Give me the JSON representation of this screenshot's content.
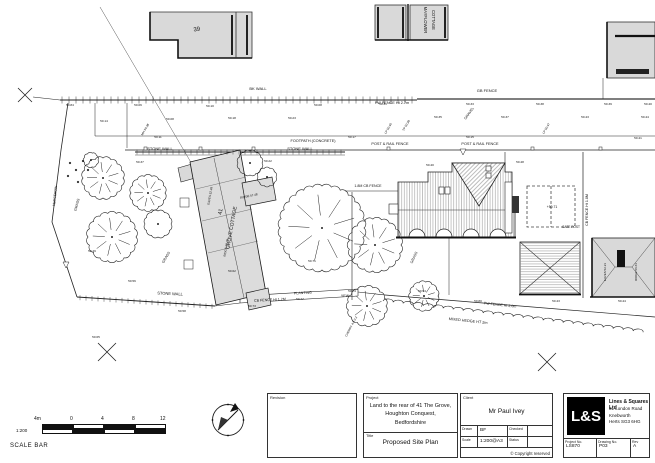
{
  "title_block": {
    "revision_label": "Revision",
    "project_label": "Project",
    "project_lines": [
      "Land to the rear of 41 The Grove,",
      "Houghton Conquest,",
      "Bedfordshire"
    ],
    "title_label": "Title",
    "title": "Proposed Site Plan",
    "client_label": "Client",
    "client": "Mr Paul Ivey",
    "drawn_label": "Drawn",
    "drawn": "BF",
    "checked_label": "Checked",
    "checked": "",
    "scale_label": "Scale",
    "scale": "1:200@A3",
    "status_label": "Status",
    "status": "",
    "copyright": "© Copyright reserved",
    "logo_text": "L&S",
    "company_name": "Lines & Squares Ltd",
    "company_address": [
      "81 London Road",
      "Knebworth",
      "Herts SG3 6HG"
    ],
    "project_no_label": "Project No.",
    "project_no": "LS870",
    "drawing_no_label": "Drawing No.",
    "drawing_no": "P03",
    "rev_label": "Rev",
    "rev": "A"
  },
  "scale_bar": {
    "ratio": "1:200",
    "caption": "SCALE BAR",
    "tick_labels": [
      "4m",
      "0",
      "4",
      "8",
      "12"
    ]
  },
  "plan": {
    "labels": [
      {
        "t": "BK WALL",
        "x": 258,
        "y": 90,
        "s": 4
      },
      {
        "t": "GB FENCE",
        "x": 487,
        "y": 92,
        "s": 4
      },
      {
        "t": "PW FENCE Ht 2.7m",
        "x": 392,
        "y": 104,
        "s": 3.8
      },
      {
        "t": "FOOTPATH (CONCRETE)",
        "x": 313,
        "y": 142,
        "s": 3.8
      },
      {
        "t": "POST & RAIL FENCE",
        "x": 390,
        "y": 145,
        "s": 3.8
      },
      {
        "t": "POST & RAIL FENCE",
        "x": 480,
        "y": 145,
        "s": 3.8
      },
      {
        "t": "39",
        "x": 197,
        "y": 31,
        "s": 6,
        "r": -8
      },
      {
        "t": "MAYFLOWER",
        "x": 424,
        "y": 20,
        "s": 4.2,
        "r": 90
      },
      {
        "t": "COTTAGE",
        "x": 432,
        "y": 20,
        "s": 4.2,
        "r": 90
      },
      {
        "t": "STONE WALL",
        "x": 160,
        "y": 150,
        "s": 4
      },
      {
        "t": "STONE WALL",
        "x": 300,
        "y": 150,
        "s": 4
      },
      {
        "t": "STONE WALL",
        "x": 170,
        "y": 295,
        "s": 4,
        "r": 3
      },
      {
        "t": "1.8M CB FENCE",
        "x": 368,
        "y": 187,
        "s": 3.6
      },
      {
        "t": "CB FENCE Ht 1.2M",
        "x": 270,
        "y": 301,
        "s": 3.6,
        "r": -3
      },
      {
        "t": "PLANTING",
        "x": 303,
        "y": 294,
        "s": 3.6,
        "r": -3
      },
      {
        "t": "YEW",
        "x": 345,
        "y": 297,
        "s": 3.6
      },
      {
        "t": "MIXED HEDGE HT 2m",
        "x": 468,
        "y": 322,
        "s": 3.8,
        "r": 6
      },
      {
        "t": "PW FENCE Ht 2.0m",
        "x": 500,
        "y": 306,
        "s": 3.6,
        "r": 6
      },
      {
        "t": "CB FENCE Ht 1.8M",
        "x": 588,
        "y": 210,
        "s": 3.6,
        "r": -90
      },
      {
        "t": "GATE POST",
        "x": 571,
        "y": 228,
        "s": 3.2
      },
      {
        "t": "41",
        "x": 222,
        "y": 212,
        "s": 5.5,
        "r": -80
      },
      {
        "t": "GROVE COTTAGE",
        "x": 233,
        "y": 228,
        "s": 5,
        "r": -80
      },
      {
        "t": "GRASS",
        "x": 78,
        "y": 205,
        "s": 3.6,
        "r": -75
      },
      {
        "t": "GRASS",
        "x": 167,
        "y": 258,
        "s": 3.6,
        "r": -60
      },
      {
        "t": "GRASS",
        "x": 415,
        "y": 258,
        "s": 3.6,
        "r": -65
      },
      {
        "t": "GRAVEL",
        "x": 470,
        "y": 114,
        "s": 3.6,
        "r": -55
      },
      {
        "t": "HEDGEROW",
        "x": 56,
        "y": 196,
        "s": 3.4,
        "r": -84
      },
      {
        "t": "CHERRY 4.0 0.2",
        "x": 352,
        "y": 327,
        "s": 3,
        "r": -62
      },
      {
        "t": "EAVES 52.48",
        "x": 211,
        "y": 196,
        "s": 3,
        "r": -80
      },
      {
        "t": "RIDGE 56.76",
        "x": 227,
        "y": 248,
        "s": 3,
        "r": -80
      },
      {
        "t": "RIDGE 57.48",
        "x": 249,
        "y": 197,
        "s": 3,
        "r": -12
      },
      {
        "t": "EAVES 52.21",
        "x": 606,
        "y": 272,
        "s": 3,
        "r": -90
      },
      {
        "t": "RIDGE 56.61",
        "x": 637,
        "y": 272,
        "s": 3,
        "r": -90
      },
      {
        "t": "+50.71",
        "x": 552,
        "y": 208,
        "s": 3.4
      },
      {
        "t": "MH 50.38",
        "x": 146,
        "y": 130,
        "s": 3,
        "r": -60
      },
      {
        "t": "LP 50.40",
        "x": 389,
        "y": 129,
        "s": 3,
        "r": -60
      },
      {
        "t": "TP 50.38",
        "x": 407,
        "y": 126,
        "s": 3,
        "r": -60
      },
      {
        "t": "LP 50.47",
        "x": 547,
        "y": 129,
        "s": 3,
        "r": -60
      },
      {
        "t": "50.84",
        "x": 70,
        "y": 106
      },
      {
        "t": "50.06",
        "x": 138,
        "y": 106
      },
      {
        "t": "50.10",
        "x": 210,
        "y": 107
      },
      {
        "t": "50.08",
        "x": 318,
        "y": 106
      },
      {
        "t": "50.31",
        "x": 383,
        "y": 105
      },
      {
        "t": "50.33",
        "x": 470,
        "y": 105
      },
      {
        "t": "50.38",
        "x": 540,
        "y": 105
      },
      {
        "t": "50.39",
        "x": 608,
        "y": 105
      },
      {
        "t": "50.40",
        "x": 648,
        "y": 105
      },
      {
        "t": "50.14",
        "x": 104,
        "y": 122
      },
      {
        "t": "50.08",
        "x": 170,
        "y": 120
      },
      {
        "t": "50.18",
        "x": 232,
        "y": 119
      },
      {
        "t": "50.23",
        "x": 292,
        "y": 119
      },
      {
        "t": "50.35",
        "x": 438,
        "y": 118
      },
      {
        "t": "50.37",
        "x": 505,
        "y": 118
      },
      {
        "t": "50.43",
        "x": 585,
        "y": 118
      },
      {
        "t": "50.44",
        "x": 645,
        "y": 118
      },
      {
        "t": "50.11",
        "x": 158,
        "y": 138
      },
      {
        "t": "50.17",
        "x": 352,
        "y": 138
      },
      {
        "t": "50.15",
        "x": 470,
        "y": 138
      },
      {
        "t": "50.41",
        "x": 638,
        "y": 139
      },
      {
        "t": "50.37",
        "x": 140,
        "y": 163
      },
      {
        "t": "50.22",
        "x": 268,
        "y": 162
      },
      {
        "t": "50.40",
        "x": 430,
        "y": 166
      },
      {
        "t": "50.48",
        "x": 520,
        "y": 163
      },
      {
        "t": "50.49",
        "x": 92,
        "y": 252
      },
      {
        "t": "50.56",
        "x": 132,
        "y": 282
      },
      {
        "t": "50.62",
        "x": 232,
        "y": 272
      },
      {
        "t": "50.71",
        "x": 312,
        "y": 262
      },
      {
        "t": "50.74",
        "x": 352,
        "y": 292
      },
      {
        "t": "50.54",
        "x": 422,
        "y": 292
      },
      {
        "t": "50.80",
        "x": 478,
        "y": 302
      },
      {
        "t": "50.43",
        "x": 556,
        "y": 302
      },
      {
        "t": "50.44",
        "x": 622,
        "y": 302
      },
      {
        "t": "50.58",
        "x": 182,
        "y": 312
      },
      {
        "t": "50.73",
        "x": 252,
        "y": 307
      },
      {
        "t": "50.77",
        "x": 300,
        "y": 300
      },
      {
        "t": "50.65",
        "x": 96,
        "y": 338
      }
    ],
    "trees": [
      {
        "x": 103,
        "y": 178,
        "r": 20,
        "s": 1
      },
      {
        "x": 148,
        "y": 193,
        "r": 17,
        "s": 1
      },
      {
        "x": 112,
        "y": 237,
        "r": 24,
        "s": 1
      },
      {
        "x": 158,
        "y": 224,
        "r": 13
      },
      {
        "x": 250,
        "y": 163,
        "r": 12
      },
      {
        "x": 267,
        "y": 177,
        "r": 9
      },
      {
        "x": 322,
        "y": 228,
        "r": 42,
        "s": 1
      },
      {
        "x": 375,
        "y": 245,
        "r": 26,
        "s": 1
      },
      {
        "x": 367,
        "y": 306,
        "r": 19,
        "s": 1
      },
      {
        "x": 424,
        "y": 296,
        "r": 14,
        "s": 1
      },
      {
        "x": 91,
        "y": 160,
        "r": 7
      }
    ]
  }
}
